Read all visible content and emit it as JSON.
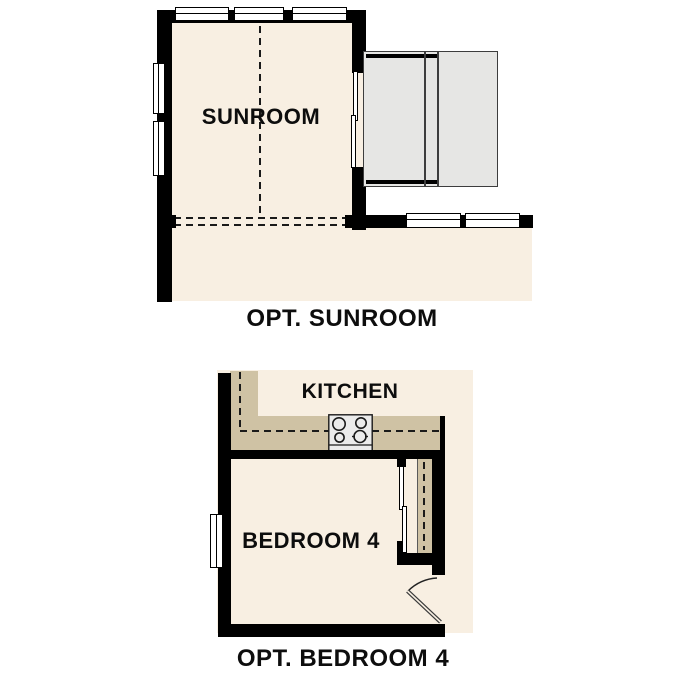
{
  "plans": {
    "sunroom": {
      "room_label": "SUNROOM",
      "caption": "OPT. SUNROOM"
    },
    "bedroom": {
      "kitchen_label": "KITCHEN",
      "room_label": "BEDROOM 4",
      "caption": "OPT. BEDROOM 4"
    }
  },
  "icons": {
    "cooktop": "4-burner-cooktop-icon",
    "door_swing": "door-swing-arc-icon",
    "windows": "double-line-window-icon",
    "sliding_door": "sliding-door-panel-icon"
  },
  "colors": {
    "wall": "#000000",
    "floor": "#f8efe2",
    "tan": "#cfc2a4",
    "deck": "#e6e6e4",
    "deck-edge": "#3d3d3d",
    "window": "#ffffff",
    "stove": "#ebebeb",
    "line": "#1a1a1a",
    "text": "#0d0d0d"
  }
}
